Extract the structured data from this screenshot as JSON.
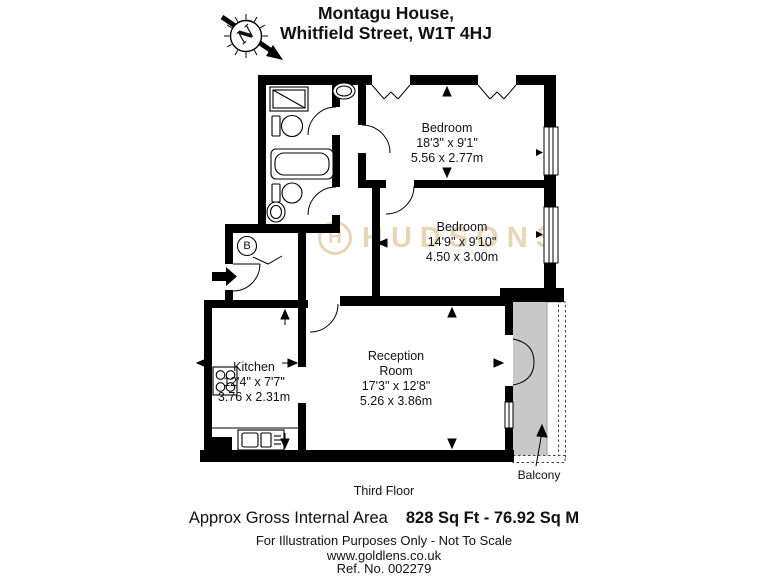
{
  "header": {
    "address_line1": "Montagu House,",
    "address_line2": "Whitfield Street, W1T 4HJ"
  },
  "compass": {
    "north_label": "N"
  },
  "watermark": {
    "logo_letter": "H",
    "brand": "HUDSONS",
    "color": "#e8d6b4"
  },
  "plan": {
    "floor_label": "Third Floor",
    "cupboard_label": "B",
    "rooms": {
      "bedroom1": {
        "name": "Bedroom",
        "imperial": "18'3\" x 9'1\"",
        "metric": "5.56 x 2.77m"
      },
      "bedroom2": {
        "name": "Bedroom",
        "imperial": "14'9\" x 9'10\"",
        "metric": "4.50 x 3.00m"
      },
      "kitchen": {
        "name": "Kitchen",
        "imperial": "12'4\" x 7'7\"",
        "metric": "3.76 x 2.31m"
      },
      "reception": {
        "name_line1": "Reception",
        "name_line2": "Room",
        "imperial": "17'3\" x 12'8\"",
        "metric": "5.26 x 3.86m"
      },
      "balcony": {
        "name": "Balcony"
      }
    }
  },
  "footer": {
    "area_label": "Approx Gross Internal Area",
    "area_value": "828 Sq Ft - 76.92 Sq M",
    "disclaimer": "For Illustration Purposes Only - Not To Scale",
    "website": "www.goldlens.co.uk",
    "reference": "Ref. No. 002279"
  }
}
